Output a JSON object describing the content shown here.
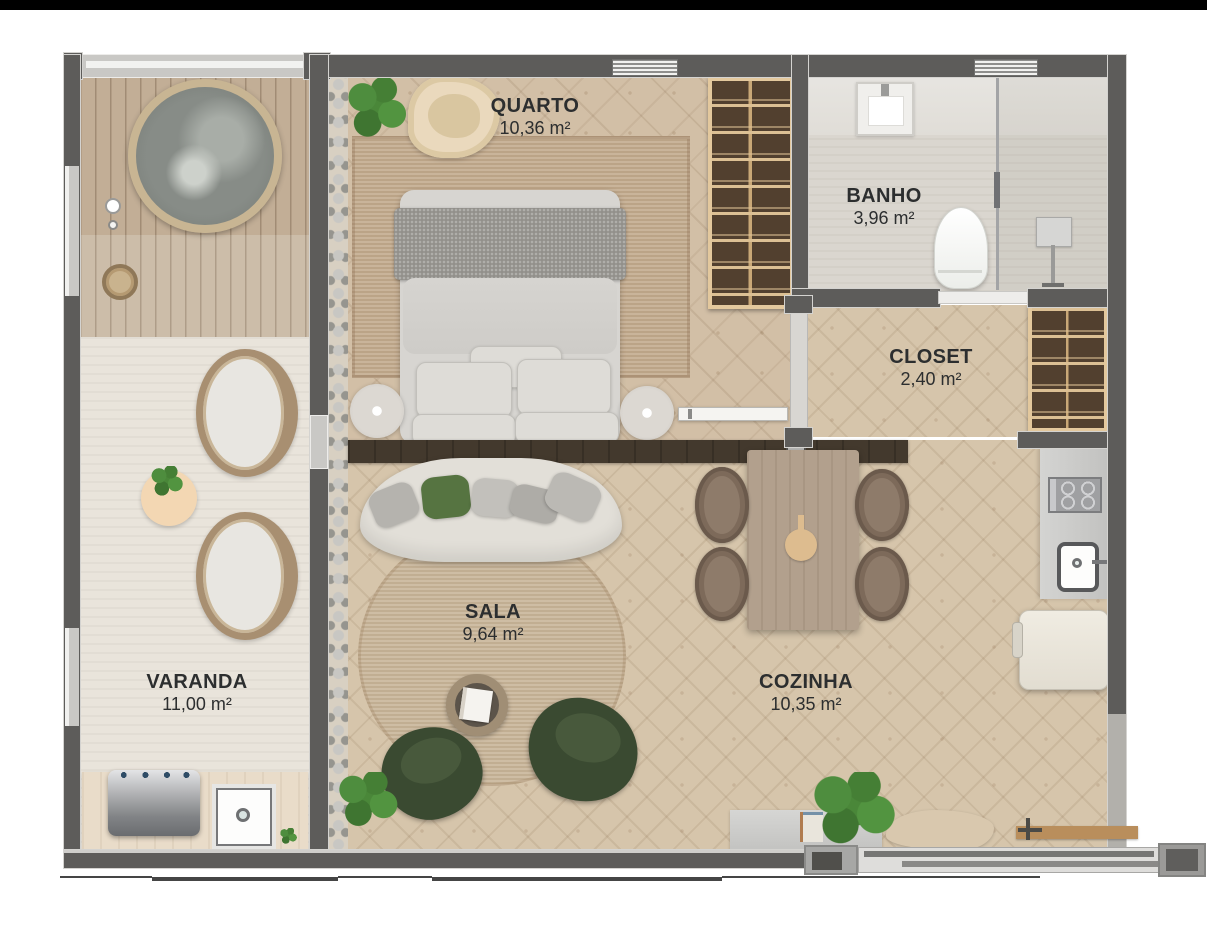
{
  "page": {
    "type": "apartment-floor-plan-top-view",
    "top_bar_color": "#000000",
    "background": "#ffffff"
  },
  "rooms": [
    {
      "id": "quarto",
      "name": "QUARTO",
      "area": "10,36 m²"
    },
    {
      "id": "banho",
      "name": "BANHO",
      "area": "3,96 m²"
    },
    {
      "id": "closet",
      "name": "CLOSET",
      "area": "2,40 m²"
    },
    {
      "id": "sala",
      "name": "SALA",
      "area": "9,64 m²"
    },
    {
      "id": "cozinha",
      "name": "COZINHA",
      "area": "10,35 m²"
    },
    {
      "id": "varanda",
      "name": "VARANDA",
      "area": "11,00 m²"
    }
  ],
  "colors": {
    "wall": "#5d5c5a",
    "wood_floor": "#d6c5ab",
    "bedroom_floor": "#d2bfa6",
    "deck": "#c2ae96",
    "rug": "#c3ab8e",
    "accent_green_chair": "#3a4a31",
    "accent_green_pillow": "#567441",
    "wardrobe_brown": "#52402f",
    "label_text": "#2c2e2f"
  }
}
